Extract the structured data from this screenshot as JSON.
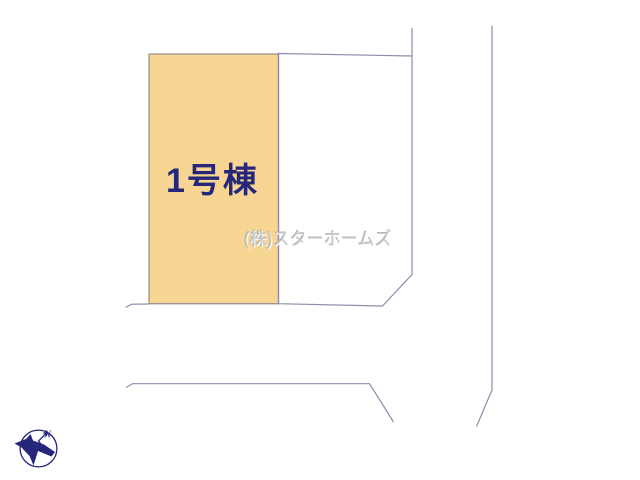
{
  "plan": {
    "plot_label": "1号棟",
    "watermark": "(株)スターホームズ",
    "compass_north_label": "N"
  },
  "colors": {
    "background": "#ffffff",
    "plot_fill": "#f7d592",
    "adjacent_plot_fill": "#ffffff",
    "boundary_line": "#8d8dab",
    "plot_outline": "#9c948f",
    "plot_label_text": "#26267a",
    "watermark_text": "#c7c7c7",
    "compass": "#26267a"
  }
}
